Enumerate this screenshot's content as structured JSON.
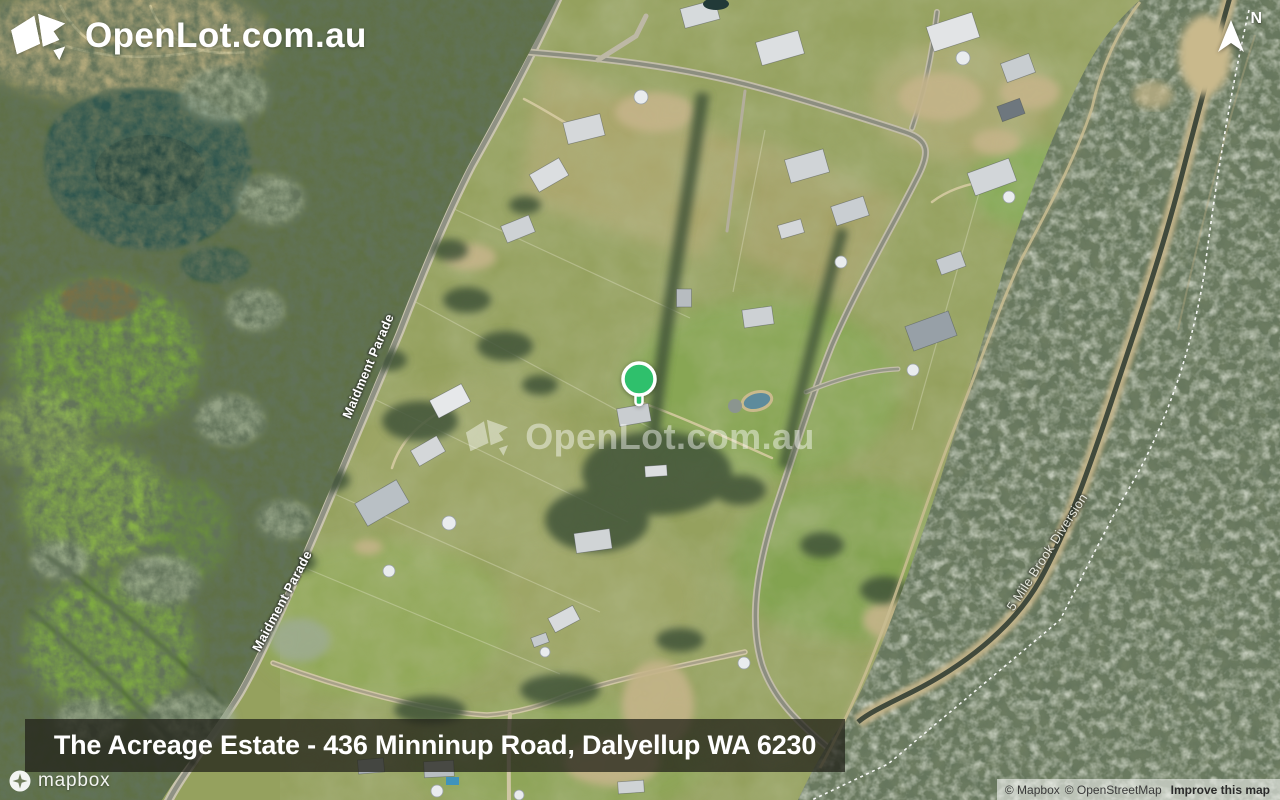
{
  "brand": {
    "logo_text": "OpenLot.com.au"
  },
  "compass": {
    "north_label": "N"
  },
  "marker": {
    "color": "#2fc06c"
  },
  "watermark": {
    "text": "OpenLot.com.au"
  },
  "map": {
    "road_labels": [
      {
        "text": "Maidment Parade"
      },
      {
        "text": "Maidment Parade"
      },
      {
        "text": "5 Mile Brook Diversion"
      }
    ]
  },
  "caption": {
    "text": "The Acreage Estate - 436 Minninup Road, Dalyellup WA 6230"
  },
  "attribution": {
    "mapbox_logo_text": "mapbox",
    "mapbox": "© Mapbox",
    "osm": "© OpenStreetMap",
    "improve_link": "Improve this map"
  }
}
